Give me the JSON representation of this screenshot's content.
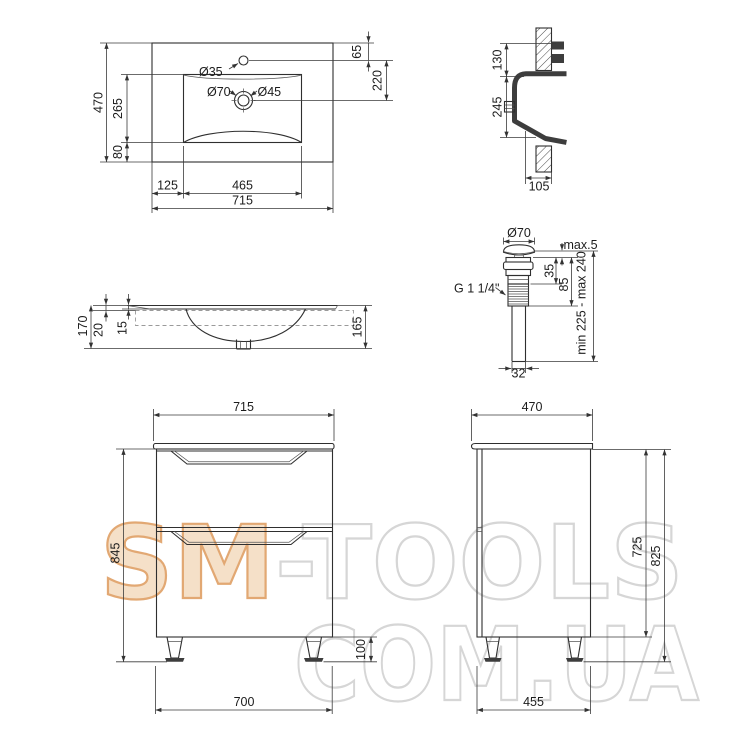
{
  "drawing": {
    "type": "technical-dimension-drawing",
    "subject": "washbasin and vanity cabinet",
    "units": "mm",
    "line_color": "#2f2f2f",
    "watermark": {
      "part1": "SM",
      "part2": "-TOOLS",
      "part3": "COM.UA",
      "accent_fill": "#f5e0c8",
      "accent_stroke": "#e2a873",
      "outline_color": "#d6d6d6"
    },
    "views": {
      "washbasin_top": {
        "title": "washbasin top view",
        "dims": {
          "overall_width": "715",
          "overall_depth": "470",
          "bowl_depth": "265",
          "front_margin": "80",
          "tap_hole_offset": "65",
          "drain_offset": "220",
          "bowl_offset_left": "125",
          "bowl_width": "465",
          "tap_hole_dia": "Ø35",
          "drain_outer_dia": "Ø70",
          "drain_inner_dia": "Ø45"
        }
      },
      "washbasin_section": {
        "title": "washbasin wall section",
        "dims": {
          "back_height": "130",
          "bowl_height": "245",
          "bottom_projection": "105"
        }
      },
      "drain_valve": {
        "title": "pop-up drain valve",
        "dims": {
          "cap_dia": "Ø70",
          "cap_gap": "max.5",
          "flange_height": "35",
          "body_height": "85",
          "total_height": "min 225 - max 240",
          "thread": "G 1 1/4\"",
          "pipe_dia": "32"
        }
      },
      "washbasin_front": {
        "title": "washbasin front profile",
        "dims": {
          "total_height": "170",
          "rim_drop": "20",
          "edge_thickness": "15",
          "bowl_height": "165"
        }
      },
      "cabinet_front": {
        "title": "cabinet front view",
        "dims": {
          "top_width": "715",
          "body_height": "845",
          "leg_height": "100",
          "bottom_width": "700"
        }
      },
      "cabinet_side": {
        "title": "cabinet side view",
        "dims": {
          "top_depth": "470",
          "body_height": "725",
          "total_height": "825",
          "bottom_depth": "455"
        }
      }
    }
  }
}
